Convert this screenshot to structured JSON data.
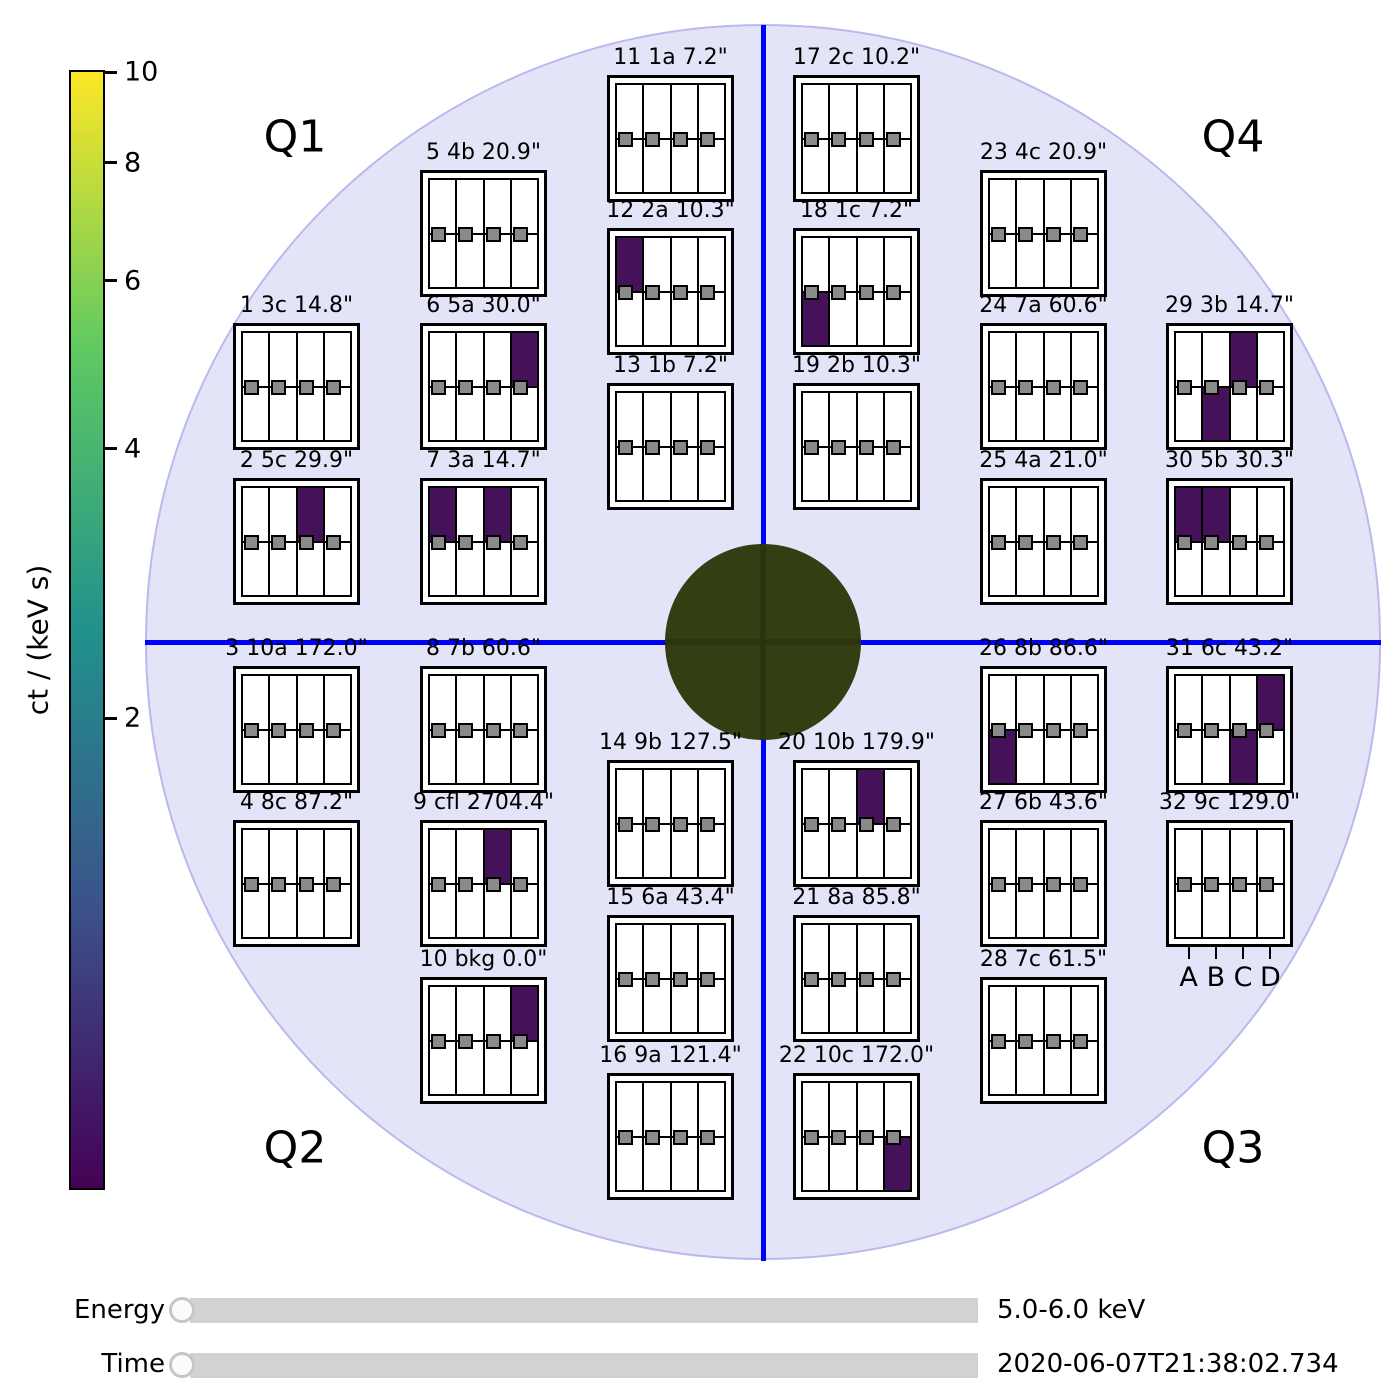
{
  "colors": {
    "background": "#ffffff",
    "quadrant_circle_fill": "#e4e4f9",
    "quadrant_circle_edge": "#b9b9ee",
    "crosshair_blue": "#0000ff",
    "center_circle_fill": "#343e13",
    "center_circle_cross": "#2b330f",
    "pixel_fill_purple": "#451159",
    "small_pixel_marker_gray": "#8a8a8a",
    "slider_track_gray": "#d2d2d2"
  },
  "sliders": {
    "energy": {
      "label": "Energy",
      "value": "5.0-6.0 keV"
    },
    "time": {
      "label": "Time",
      "value": "2020-06-07T21:38:02.734"
    }
  },
  "chart_data": {
    "type": "heatmap",
    "quadrants": [
      "Q1",
      "Q2",
      "Q3",
      "Q4"
    ],
    "pixel_columns": [
      "A",
      "B",
      "C",
      "D"
    ],
    "colorbar": {
      "label": "ct / (keV s)",
      "scale": "log",
      "top_value": 10,
      "ticks": [
        {
          "value": 10,
          "pct": 0.2
        },
        {
          "value": 8,
          "pct": 8.3
        },
        {
          "value": 6,
          "pct": 18.8
        },
        {
          "value": 4,
          "pct": 33.8
        },
        {
          "value": 2,
          "pct": 57.9
        }
      ],
      "gradient": [
        "#fde725",
        "#5ec962",
        "#21918c",
        "#3b528b",
        "#440154"
      ]
    },
    "filled_pixel_value_estimate": 1,
    "energy_range": "5.0-6.0 keV",
    "timestamp": "2020-06-07T21:38:02.734",
    "detectors": [
      {
        "num": 1,
        "grid": "3c",
        "res": "14.8\"",
        "title": "1 3c 14.8\"",
        "x": 233,
        "y": 323,
        "filled": []
      },
      {
        "num": 2,
        "grid": "5c",
        "res": "29.9\"",
        "title": "2 5c 29.9\"",
        "x": 233,
        "y": 478,
        "filled": [
          {
            "pixel": "C",
            "row": "top"
          }
        ]
      },
      {
        "num": 3,
        "grid": "10a",
        "res": "172.0\"",
        "title": "3 10a 172.0\"",
        "x": 233,
        "y": 666,
        "filled": []
      },
      {
        "num": 4,
        "grid": "8c",
        "res": "87.2\"",
        "title": "4 8c 87.2\"",
        "x": 233,
        "y": 820,
        "filled": []
      },
      {
        "num": 5,
        "grid": "4b",
        "res": "20.9\"",
        "title": "5 4b 20.9\"",
        "x": 420,
        "y": 170,
        "filled": []
      },
      {
        "num": 6,
        "grid": "5a",
        "res": "30.0\"",
        "title": "6 5a 30.0\"",
        "x": 420,
        "y": 323,
        "filled": [
          {
            "pixel": "D",
            "row": "top"
          }
        ]
      },
      {
        "num": 7,
        "grid": "3a",
        "res": "14.7\"",
        "title": "7 3a 14.7\"",
        "x": 420,
        "y": 478,
        "filled": [
          {
            "pixel": "A",
            "row": "top"
          },
          {
            "pixel": "C",
            "row": "top"
          }
        ]
      },
      {
        "num": 8,
        "grid": "7b",
        "res": "60.6\"",
        "title": "8 7b 60.6\"",
        "x": 420,
        "y": 666,
        "filled": []
      },
      {
        "num": 9,
        "grid": "cfl",
        "res": "2704.4\"",
        "title": "9 cfl 2704.4\"",
        "x": 420,
        "y": 820,
        "filled": [
          {
            "pixel": "C",
            "row": "top"
          }
        ]
      },
      {
        "num": 10,
        "grid": "bkg",
        "res": "0.0\"",
        "title": "10 bkg 0.0\"",
        "x": 420,
        "y": 977,
        "filled": [
          {
            "pixel": "D",
            "row": "top"
          }
        ]
      },
      {
        "num": 11,
        "grid": "1a",
        "res": "7.2\"",
        "title": "11 1a 7.2\"",
        "x": 607,
        "y": 75,
        "filled": []
      },
      {
        "num": 12,
        "grid": "2a",
        "res": "10.3\"",
        "title": "12 2a 10.3\"",
        "x": 607,
        "y": 228,
        "filled": [
          {
            "pixel": "A",
            "row": "top"
          }
        ]
      },
      {
        "num": 13,
        "grid": "1b",
        "res": "7.2\"",
        "title": "13 1b 7.2\"",
        "x": 607,
        "y": 383,
        "filled": []
      },
      {
        "num": 14,
        "grid": "9b",
        "res": "127.5\"",
        "title": "14 9b 127.5\"",
        "x": 607,
        "y": 760,
        "filled": []
      },
      {
        "num": 15,
        "grid": "6a",
        "res": "43.4\"",
        "title": "15 6a 43.4\"",
        "x": 607,
        "y": 915,
        "filled": []
      },
      {
        "num": 16,
        "grid": "9a",
        "res": "121.4\"",
        "title": "16 9a 121.4\"",
        "x": 607,
        "y": 1073,
        "filled": []
      },
      {
        "num": 17,
        "grid": "2c",
        "res": "10.2\"",
        "title": "17 2c 10.2\"",
        "x": 793,
        "y": 75,
        "filled": []
      },
      {
        "num": 18,
        "grid": "1c",
        "res": "7.2\"",
        "title": "18 1c 7.2\"",
        "x": 793,
        "y": 228,
        "filled": [
          {
            "pixel": "A",
            "row": "bottom"
          }
        ]
      },
      {
        "num": 19,
        "grid": "2b",
        "res": "10.3\"",
        "title": "19 2b 10.3\"",
        "x": 793,
        "y": 383,
        "filled": []
      },
      {
        "num": 20,
        "grid": "10b",
        "res": "179.9\"",
        "title": "20 10b 179.9\"",
        "x": 793,
        "y": 760,
        "filled": [
          {
            "pixel": "C",
            "row": "top"
          }
        ]
      },
      {
        "num": 21,
        "grid": "8a",
        "res": "85.8\"",
        "title": "21 8a 85.8\"",
        "x": 793,
        "y": 915,
        "filled": []
      },
      {
        "num": 22,
        "grid": "10c",
        "res": "172.0\"",
        "title": "22 10c 172.0\"",
        "x": 793,
        "y": 1073,
        "filled": [
          {
            "pixel": "D",
            "row": "bottom"
          }
        ]
      },
      {
        "num": 23,
        "grid": "4c",
        "res": "20.9\"",
        "title": "23 4c 20.9\"",
        "x": 980,
        "y": 170,
        "filled": []
      },
      {
        "num": 24,
        "grid": "7a",
        "res": "60.6\"",
        "title": "24 7a 60.6\"",
        "x": 980,
        "y": 323,
        "filled": []
      },
      {
        "num": 25,
        "grid": "4a",
        "res": "21.0\"",
        "title": "25 4a 21.0\"",
        "x": 980,
        "y": 478,
        "filled": []
      },
      {
        "num": 26,
        "grid": "8b",
        "res": "86.6\"",
        "title": "26 8b 86.6\"",
        "x": 980,
        "y": 666,
        "filled": [
          {
            "pixel": "A",
            "row": "bottom"
          }
        ]
      },
      {
        "num": 27,
        "grid": "6b",
        "res": "43.6\"",
        "title": "27 6b 43.6\"",
        "x": 980,
        "y": 820,
        "filled": []
      },
      {
        "num": 28,
        "grid": "7c",
        "res": "61.5\"",
        "title": "28 7c 61.5\"",
        "x": 980,
        "y": 977,
        "filled": []
      },
      {
        "num": 29,
        "grid": "3b",
        "res": "14.7\"",
        "title": "29 3b 14.7\"",
        "x": 1166,
        "y": 323,
        "filled": [
          {
            "pixel": "B",
            "row": "bottom"
          },
          {
            "pixel": "C",
            "row": "top"
          }
        ]
      },
      {
        "num": 30,
        "grid": "5b",
        "res": "30.3\"",
        "title": "30 5b 30.3\"",
        "x": 1166,
        "y": 478,
        "filled": [
          {
            "pixel": "A",
            "row": "top"
          },
          {
            "pixel": "B",
            "row": "top"
          }
        ]
      },
      {
        "num": 31,
        "grid": "6c",
        "res": "43.2\"",
        "title": "31 6c 43.2\"",
        "x": 1166,
        "y": 666,
        "filled": [
          {
            "pixel": "C",
            "row": "bottom"
          },
          {
            "pixel": "D",
            "row": "top"
          }
        ]
      },
      {
        "num": 32,
        "grid": "9c",
        "res": "129.0\"",
        "title": "32 9c 129.0\"",
        "x": 1166,
        "y": 820,
        "filled": []
      }
    ],
    "quadrant_label_positions": [
      {
        "label": "Q1",
        "x": 295,
        "y": 137
      },
      {
        "label": "Q2",
        "x": 295,
        "y": 1148
      },
      {
        "label": "Q3",
        "x": 1233,
        "y": 1148
      },
      {
        "label": "Q4",
        "x": 1233,
        "y": 137
      }
    ]
  }
}
